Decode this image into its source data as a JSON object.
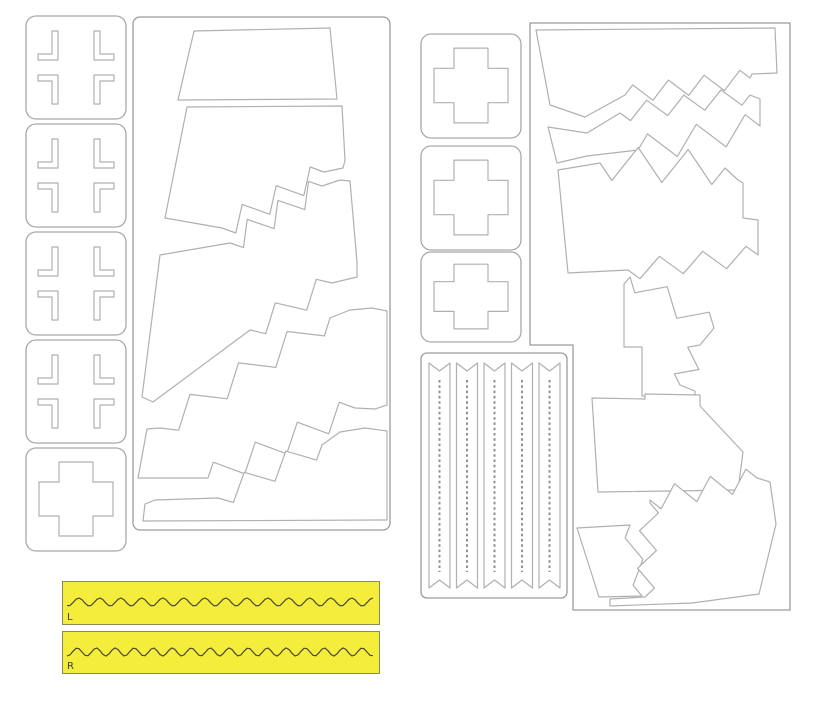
{
  "document": {
    "type": "paint-mask-cutting-sheet",
    "background": "#ffffff"
  },
  "colors": {
    "panel_stroke": "#9c9c9c",
    "square_stroke": "#a8a8a8",
    "shape_stroke": "#b0b0b0",
    "shape_fill": "#ffffff",
    "dash_stroke": "#8f8f8f",
    "yellow_fill": "#f5ed3c",
    "yellow_border": "#8a8a5f",
    "wave_stroke": "#4a4a35",
    "label_color": "#3f3f32"
  },
  "left_cross_column": {
    "squares": [
      {
        "x": 26,
        "y": 16,
        "w": 100,
        "h": 103,
        "kind": "bracket",
        "name": "balkenkreuz-corner-mask"
      },
      {
        "x": 26,
        "y": 124,
        "w": 100,
        "h": 103,
        "kind": "bracket",
        "name": "balkenkreuz-corner-mask"
      },
      {
        "x": 26,
        "y": 232,
        "w": 100,
        "h": 103,
        "kind": "bracket",
        "name": "balkenkreuz-corner-mask"
      },
      {
        "x": 26,
        "y": 340,
        "w": 100,
        "h": 103,
        "kind": "bracket",
        "name": "balkenkreuz-corner-mask"
      },
      {
        "x": 26,
        "y": 448,
        "w": 100,
        "h": 103,
        "kind": "plus",
        "name": "plus-cross-mask"
      }
    ]
  },
  "right_cross_column": {
    "squares": [
      {
        "x": 421,
        "y": 34,
        "w": 100,
        "h": 104,
        "kind": "plus",
        "name": "plus-cross-mask"
      },
      {
        "x": 421,
        "y": 146,
        "w": 100,
        "h": 104,
        "kind": "plus",
        "name": "plus-cross-mask"
      },
      {
        "x": 421,
        "y": 252,
        "w": 100,
        "h": 90,
        "kind": "plus",
        "name": "plus-cross-mask"
      }
    ]
  },
  "panel_a": {
    "frame": {
      "x": 133,
      "y": 17,
      "w": 257,
      "h": 513,
      "rx": 7
    },
    "shapes": [
      {
        "name": "camo-mask-top-trapezoid",
        "ops": [
          [
            "M",
            194,
            31
          ],
          [
            "L",
            330,
            28
          ],
          [
            "L",
            337,
            99
          ],
          [
            "L",
            178,
            100
          ],
          [
            "C"
          ]
        ]
      },
      {
        "name": "camo-mask-band",
        "ops": [
          [
            "M",
            187,
            107
          ],
          [
            "L",
            342,
            106
          ],
          [
            "L",
            345,
            160
          ],
          [
            "L",
            343,
            168
          ],
          [
            "L",
            324,
            172
          ],
          [
            "G",
            222,
            228,
            6,
            11
          ],
          [
            "L",
            165,
            218
          ],
          [
            "C"
          ]
        ]
      },
      {
        "name": "camo-mask-band",
        "ops": [
          [
            "M",
            160,
            255
          ],
          [
            "L",
            230,
            243
          ],
          [
            "G",
            322,
            186,
            6,
            11
          ],
          [
            "L",
            340,
            180
          ],
          [
            "L",
            350,
            181
          ],
          [
            "L",
            357,
            262
          ],
          [
            "L",
            357,
            277
          ],
          [
            "L",
            332,
            283
          ],
          [
            "G",
            250,
            330,
            4,
            11
          ],
          [
            "L",
            153,
            402
          ],
          [
            "L",
            142,
            397
          ],
          [
            "C"
          ]
        ]
      },
      {
        "name": "camo-mask-band",
        "ops": [
          [
            "M",
            147,
            429
          ],
          [
            "L",
            160,
            428
          ],
          [
            "G",
            330,
            318,
            7,
            12
          ],
          [
            "L",
            350,
            310
          ],
          [
            "L",
            372,
            308
          ],
          [
            "L",
            387,
            311
          ],
          [
            "L",
            387,
            405
          ],
          [
            "L",
            375,
            409
          ],
          [
            "L",
            355,
            408
          ],
          [
            "G",
            208,
            478,
            7,
            12
          ],
          [
            "L",
            138,
            478
          ],
          [
            "C"
          ]
        ]
      },
      {
        "name": "camo-mask-bottom-strip",
        "ops": [
          [
            "M",
            155,
            500
          ],
          [
            "L",
            218,
            498
          ],
          [
            "G",
            322,
            445,
            5,
            11
          ],
          [
            "L",
            340,
            432
          ],
          [
            "L",
            365,
            428
          ],
          [
            "L",
            387,
            431
          ],
          [
            "L",
            387,
            520
          ],
          [
            "L",
            143,
            521
          ],
          [
            "L",
            145,
            504
          ],
          [
            "C"
          ]
        ]
      }
    ]
  },
  "panel_b": {
    "frame_ops": [
      [
        "M",
        530,
        23
      ],
      [
        "L",
        790,
        23
      ],
      [
        "L",
        790,
        610
      ],
      [
        "L",
        573,
        610
      ],
      [
        "L",
        573,
        345
      ],
      [
        "L",
        530,
        345
      ],
      [
        "C"
      ]
    ],
    "shapes": [
      {
        "name": "camo-mask-top-band",
        "ops": [
          [
            "M",
            536,
            30
          ],
          [
            "L",
            775,
            28
          ],
          [
            "L",
            777,
            73
          ],
          [
            "L",
            752,
            74
          ],
          [
            "L",
            750,
            78
          ],
          [
            "G",
            625,
            95,
            7,
            9
          ],
          [
            "L",
            585,
            117
          ],
          [
            "L",
            550,
            105
          ],
          [
            "C"
          ]
        ]
      },
      {
        "name": "camo-mask-thin-band",
        "ops": [
          [
            "M",
            548,
            127
          ],
          [
            "L",
            587,
            133
          ],
          [
            "L",
            620,
            113
          ],
          [
            "G",
            750,
            95,
            7,
            9
          ],
          [
            "L",
            760,
            99
          ],
          [
            "L",
            760,
            126
          ],
          [
            "G",
            638,
            150,
            5,
            14
          ],
          [
            "L",
            587,
            156
          ],
          [
            "L",
            557,
            163
          ],
          [
            "C"
          ]
        ]
      },
      {
        "name": "camo-mask-band",
        "ops": [
          [
            "M",
            558,
            170
          ],
          [
            "L",
            600,
            163
          ],
          [
            "G",
            725,
            168,
            5,
            17
          ],
          [
            "L",
            738,
            180
          ],
          [
            "L",
            743,
            183
          ],
          [
            "L",
            743,
            218
          ],
          [
            "L",
            758,
            220
          ],
          [
            "L",
            758,
            255
          ],
          [
            "G",
            628,
            270,
            6,
            10
          ],
          [
            "L",
            568,
            273
          ],
          [
            "C"
          ]
        ]
      },
      {
        "name": "camo-mask-staircase-strip",
        "ops": [
          [
            "M",
            630,
            277
          ],
          [
            "G",
            714,
            328,
            4,
            11
          ],
          [
            "L",
            700,
            345
          ],
          [
            "G",
            680,
            385,
            3,
            10
          ],
          [
            "L",
            695,
            391
          ],
          [
            "L",
            695,
            401
          ],
          [
            "L",
            668,
            401
          ],
          [
            "L",
            668,
            396
          ],
          [
            "L",
            642,
            396
          ],
          [
            "L",
            642,
            347
          ],
          [
            "L",
            624,
            347
          ],
          [
            "L",
            624,
            284
          ],
          [
            "C"
          ]
        ]
      },
      {
        "name": "camo-mask-notched-trapezoid",
        "ops": [
          [
            "M",
            592,
            398
          ],
          [
            "L",
            645,
            399
          ],
          [
            "L",
            645,
            394
          ],
          [
            "L",
            700,
            395
          ],
          [
            "L",
            700,
            406
          ],
          [
            "L",
            743,
            452
          ],
          [
            "L",
            738,
            490
          ],
          [
            "L",
            598,
            492
          ],
          [
            "C"
          ]
        ]
      },
      {
        "name": "camo-mask-small-trapezoid",
        "ops": [
          [
            "M",
            577,
            528
          ],
          [
            "L",
            630,
            525
          ],
          [
            "G",
            642,
            596,
            3,
            7
          ],
          [
            "L",
            599,
            597
          ],
          [
            "C"
          ]
        ]
      },
      {
        "name": "camo-mask-bottom-piece",
        "ops": [
          [
            "M",
            650,
            500
          ],
          [
            "G",
            757,
            478,
            6,
            11
          ],
          [
            "L",
            770,
            482
          ],
          [
            "L",
            776,
            524
          ],
          [
            "L",
            759,
            594
          ],
          [
            "L",
            692,
            603
          ],
          [
            "L",
            610,
            606
          ],
          [
            "L",
            610,
            599
          ],
          [
            "L",
            645,
            597
          ],
          [
            "G",
            650,
            503,
            5,
            9
          ],
          [
            "C"
          ]
        ]
      }
    ]
  },
  "stripe_panel": {
    "frame": {
      "x": 421,
      "y": 353,
      "w": 146,
      "h": 245,
      "rx": 6
    },
    "strip_x": [
      429,
      456.5,
      484,
      511.5,
      539
    ],
    "strip_w": 21,
    "strip_y1": 363,
    "strip_y2": 588,
    "notch": 8,
    "dash_y1": 380,
    "dash_y2": 572,
    "name": "walkway-stripe-masks"
  },
  "yellow_strips": {
    "strips": [
      {
        "x": 62,
        "y": 581,
        "w": 318,
        "h": 44,
        "label": "L",
        "wave_y": 20,
        "amp": 4,
        "period": 21
      },
      {
        "x": 62,
        "y": 631,
        "w": 318,
        "h": 43,
        "label": "R",
        "wave_y": 20,
        "amp": 4,
        "period": 19
      }
    ]
  }
}
